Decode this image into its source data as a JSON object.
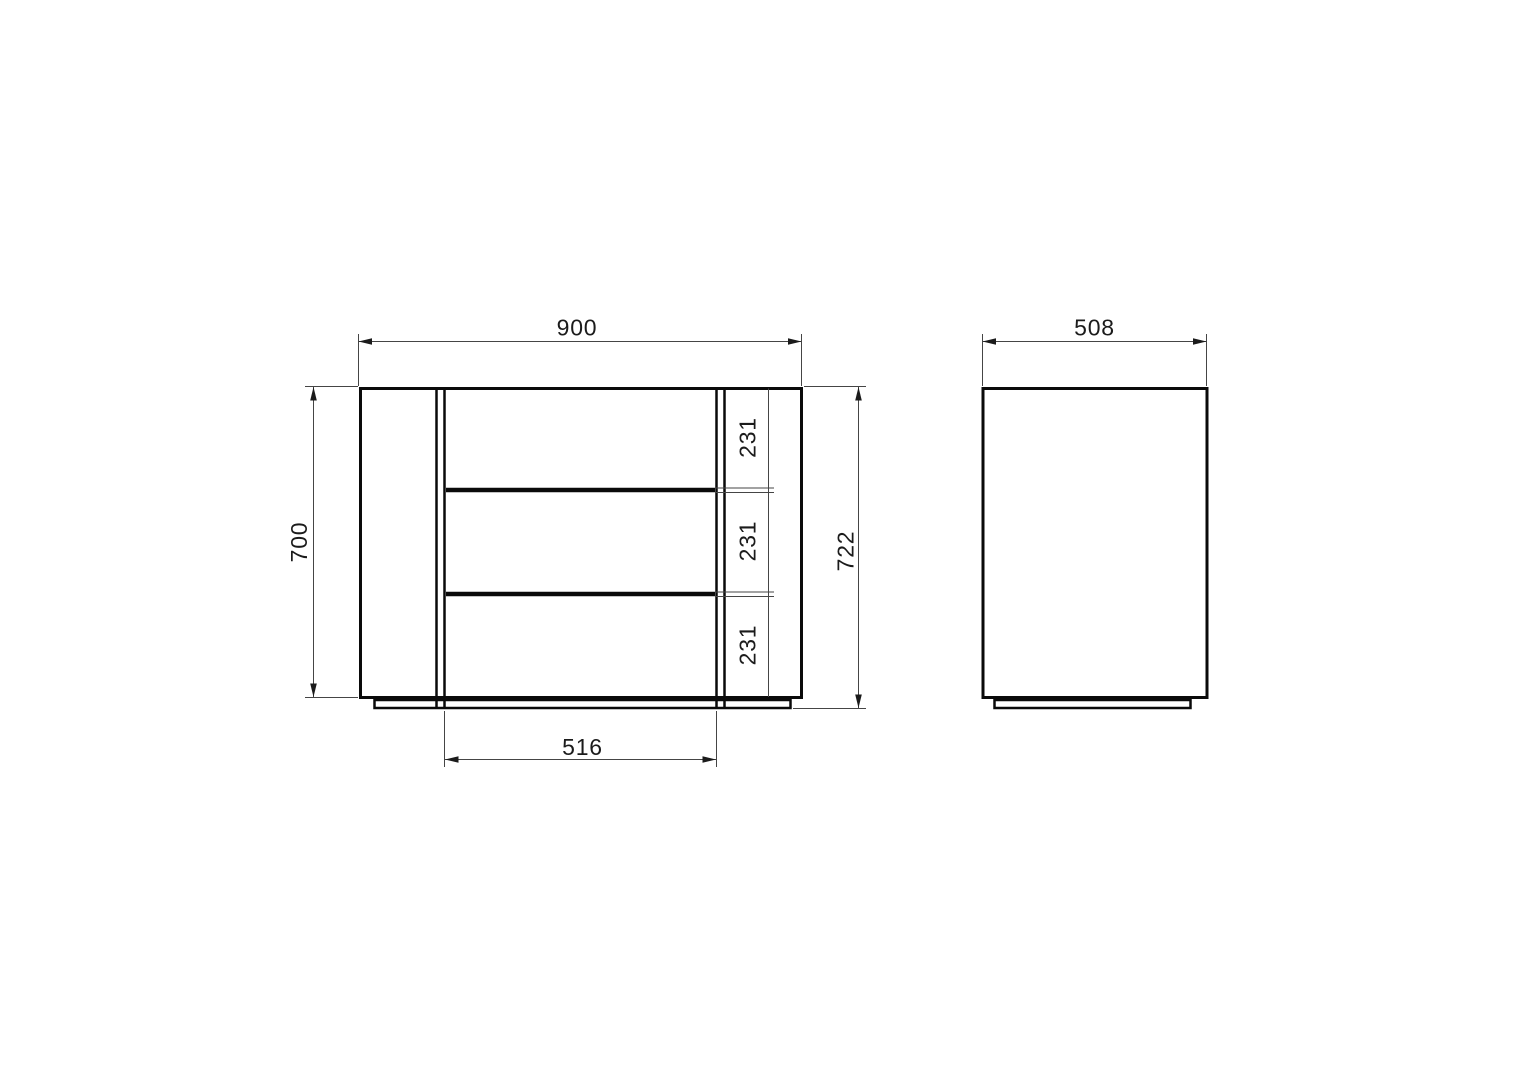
{
  "drawing": {
    "front_view": {
      "overall_width_mm": "900",
      "body_height_mm": "700",
      "total_height_mm": "722",
      "drawer_front_heights_mm": [
        "231",
        "231",
        "231"
      ],
      "drawer_bank_width_mm": "516"
    },
    "side_view": {
      "depth_mm": "508"
    },
    "style": {
      "background": "#ffffff",
      "outline_color": "#0a0a0a",
      "dimension_line_color": "#454545",
      "label_color": "#1b1b1b"
    }
  }
}
